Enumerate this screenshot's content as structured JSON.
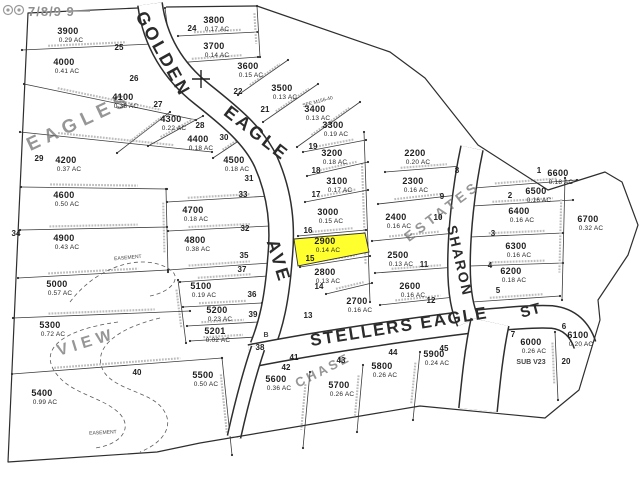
{
  "map": {
    "title": "subdivision plat map",
    "highlight": {
      "lot_id": "2900",
      "color": "#ffff2e"
    },
    "watermark": {
      "text": "7/8/9 9"
    },
    "streets": [
      {
        "label": "GOLDEN",
        "x": 158,
        "y": 57,
        "rotate": 61,
        "size": 18,
        "spacing": 3
      },
      {
        "label": "EAGLE",
        "x": 253,
        "y": 138,
        "rotate": 38,
        "size": 18,
        "spacing": 3
      },
      {
        "label": "AVE",
        "x": 273,
        "y": 263,
        "rotate": 73,
        "size": 18,
        "spacing": 3
      },
      {
        "label": "SHARON",
        "x": 455,
        "y": 262,
        "rotate": 77,
        "size": 14,
        "spacing": 2
      },
      {
        "label": "STELLERS EAGLE",
        "x": 400,
        "y": 332,
        "rotate": -9,
        "size": 17,
        "spacing": 2
      },
      {
        "label": "ST",
        "x": 532,
        "y": 315,
        "rotate": -15,
        "size": 15,
        "spacing": 1
      }
    ],
    "subdivision_labels": [
      {
        "label": "EAGLES",
        "x": 82,
        "y": 127,
        "rotate": -25,
        "size": 19,
        "spacing": 6
      },
      {
        "label": "ESTATES",
        "x": 445,
        "y": 215,
        "rotate": -37,
        "size": 14,
        "spacing": 4
      },
      {
        "label": "VIEW",
        "x": 88,
        "y": 347,
        "rotate": -17,
        "size": 16,
        "spacing": 5
      },
      {
        "label": "CHASE",
        "x": 325,
        "y": 374,
        "rotate": -27,
        "size": 13,
        "spacing": 3
      }
    ],
    "lots": [
      {
        "id": "3800",
        "area": "0.17 AC",
        "x": 214,
        "y": 23
      },
      {
        "id": "3700",
        "area": "0.14 AC",
        "x": 214,
        "y": 49
      },
      {
        "id": "3900",
        "area": "0.29 AC",
        "x": 68,
        "y": 34
      },
      {
        "id": "4000",
        "area": "0.41 AC",
        "x": 64,
        "y": 65
      },
      {
        "id": "4100",
        "area": "0.38 AC",
        "x": 123,
        "y": 100
      },
      {
        "id": "4300",
        "area": "0.22 AC",
        "x": 171,
        "y": 122
      },
      {
        "id": "4400",
        "area": "0.18 AC",
        "x": 198,
        "y": 142
      },
      {
        "id": "4500",
        "area": "0.18 AC",
        "x": 234,
        "y": 163
      },
      {
        "id": "3600",
        "area": "0.15 AC",
        "x": 248,
        "y": 69
      },
      {
        "id": "3500",
        "area": "0.13 AC",
        "x": 282,
        "y": 91
      },
      {
        "id": "3400",
        "area": "0.13 AC",
        "x": 315,
        "y": 112
      },
      {
        "id": "3300",
        "area": "0.19 AC",
        "x": 333,
        "y": 128
      },
      {
        "id": "3200",
        "area": "0.18 AC",
        "x": 332,
        "y": 156
      },
      {
        "id": "3100",
        "area": "0.17 AC",
        "x": 337,
        "y": 184
      },
      {
        "id": "3000",
        "area": "0.15 AC",
        "x": 328,
        "y": 215
      },
      {
        "id": "2900",
        "area": "0.14 AC",
        "x": 325,
        "y": 244,
        "highlighted": true
      },
      {
        "id": "2800",
        "area": "0.13 AC",
        "x": 325,
        "y": 275
      },
      {
        "id": "2700",
        "area": "0.16 AC",
        "x": 357,
        "y": 304
      },
      {
        "id": "2600",
        "area": "0.16 AC",
        "x": 410,
        "y": 289
      },
      {
        "id": "2500",
        "area": "0.13 AC",
        "x": 398,
        "y": 258
      },
      {
        "id": "2400",
        "area": "0.16 AC",
        "x": 396,
        "y": 220
      },
      {
        "id": "2300",
        "area": "0.16 AC",
        "x": 413,
        "y": 184
      },
      {
        "id": "2200",
        "area": "0.20 AC",
        "x": 415,
        "y": 156
      },
      {
        "id": "4200",
        "area": "0.37 AC",
        "x": 66,
        "y": 163
      },
      {
        "id": "4600",
        "area": "0.50 AC",
        "x": 64,
        "y": 198
      },
      {
        "id": "4700",
        "area": "0.18 AC",
        "x": 193,
        "y": 213
      },
      {
        "id": "4800",
        "area": "0.38 AC",
        "x": 195,
        "y": 243
      },
      {
        "id": "4900",
        "area": "0.43 AC",
        "x": 64,
        "y": 241
      },
      {
        "id": "5000",
        "area": "0.57 AC",
        "x": 57,
        "y": 287
      },
      {
        "id": "5100",
        "area": "0.19 AC",
        "x": 201,
        "y": 289
      },
      {
        "id": "5200",
        "area": "0.23 AC",
        "x": 217,
        "y": 313
      },
      {
        "id": "5201",
        "area": "0.02 AC",
        "x": 215,
        "y": 334
      },
      {
        "id": "5300",
        "area": "0.72 AC",
        "x": 50,
        "y": 328
      },
      {
        "id": "5400",
        "area": "0.99 AC",
        "x": 42,
        "y": 396
      },
      {
        "id": "5500",
        "area": "0.50 AC",
        "x": 203,
        "y": 378
      },
      {
        "id": "5600",
        "area": "0.36 AC",
        "x": 276,
        "y": 382
      },
      {
        "id": "5700",
        "area": "0.26 AC",
        "x": 339,
        "y": 388
      },
      {
        "id": "5800",
        "area": "0.26 AC",
        "x": 382,
        "y": 369
      },
      {
        "id": "5900",
        "area": "0.24 AC",
        "x": 434,
        "y": 357
      },
      {
        "id": "6000",
        "area": "0.26 AC",
        "x": 531,
        "y": 345
      },
      {
        "id": "6100",
        "area": "0.20 AC",
        "x": 578,
        "y": 338
      },
      {
        "id": "6200",
        "area": "0.18 AC",
        "x": 511,
        "y": 274
      },
      {
        "id": "6300",
        "area": "0.16 AC",
        "x": 516,
        "y": 249
      },
      {
        "id": "6400",
        "area": "0.16 AC",
        "x": 519,
        "y": 214
      },
      {
        "id": "6500",
        "area": "0.16 AC",
        "x": 536,
        "y": 194
      },
      {
        "id": "6600",
        "area": "0.18 AC",
        "x": 558,
        "y": 176
      },
      {
        "id": "6700",
        "area": "0.32 AC",
        "x": 588,
        "y": 222
      }
    ],
    "lot_numbers": [
      {
        "n": "25",
        "x": 119,
        "y": 50
      },
      {
        "n": "26",
        "x": 134,
        "y": 81
      },
      {
        "n": "27",
        "x": 158,
        "y": 107
      },
      {
        "n": "28",
        "x": 200,
        "y": 128
      },
      {
        "n": "30",
        "x": 224,
        "y": 140
      },
      {
        "n": "29",
        "x": 39,
        "y": 161
      },
      {
        "n": "34",
        "x": 16,
        "y": 236
      },
      {
        "n": "22",
        "x": 238,
        "y": 94
      },
      {
        "n": "21",
        "x": 265,
        "y": 112
      },
      {
        "n": "24",
        "x": 192,
        "y": 31
      },
      {
        "n": "31",
        "x": 249,
        "y": 181
      },
      {
        "n": "33",
        "x": 243,
        "y": 197
      },
      {
        "n": "32",
        "x": 245,
        "y": 231
      },
      {
        "n": "35",
        "x": 244,
        "y": 258
      },
      {
        "n": "37",
        "x": 242,
        "y": 272
      },
      {
        "n": "36",
        "x": 252,
        "y": 297
      },
      {
        "n": "39",
        "x": 253,
        "y": 317
      },
      {
        "n": "38",
        "x": 260,
        "y": 350
      },
      {
        "n": "41",
        "x": 294,
        "y": 360
      },
      {
        "n": "19",
        "x": 313,
        "y": 149
      },
      {
        "n": "18",
        "x": 316,
        "y": 173
      },
      {
        "n": "17",
        "x": 316,
        "y": 197
      },
      {
        "n": "16",
        "x": 308,
        "y": 233
      },
      {
        "n": "15",
        "x": 310,
        "y": 261
      },
      {
        "n": "14",
        "x": 319,
        "y": 289
      },
      {
        "n": "13",
        "x": 308,
        "y": 318
      },
      {
        "n": "12",
        "x": 431,
        "y": 303
      },
      {
        "n": "11",
        "x": 424,
        "y": 267
      },
      {
        "n": "10",
        "x": 438,
        "y": 220
      },
      {
        "n": "9",
        "x": 442,
        "y": 199
      },
      {
        "n": "8",
        "x": 457,
        "y": 173
      },
      {
        "n": "5",
        "x": 498,
        "y": 293
      },
      {
        "n": "4",
        "x": 490,
        "y": 268
      },
      {
        "n": "3",
        "x": 493,
        "y": 236
      },
      {
        "n": "2",
        "x": 510,
        "y": 198
      },
      {
        "n": "1",
        "x": 539,
        "y": 173
      },
      {
        "n": "42",
        "x": 286,
        "y": 370
      },
      {
        "n": "43",
        "x": 341,
        "y": 363
      },
      {
        "n": "44",
        "x": 393,
        "y": 355
      },
      {
        "n": "45",
        "x": 444,
        "y": 351
      },
      {
        "n": "7",
        "x": 513,
        "y": 337
      },
      {
        "n": "6",
        "x": 564,
        "y": 329
      },
      {
        "n": "20",
        "x": 566,
        "y": 364
      },
      {
        "n": "40",
        "x": 137,
        "y": 375
      }
    ],
    "annotations": [
      {
        "text": "SUB V23",
        "x": 531,
        "y": 364,
        "size": 7,
        "rotate": 0,
        "bold": true
      },
      {
        "text": "B",
        "x": 266,
        "y": 337,
        "size": 7,
        "rotate": 0,
        "bold": true
      },
      {
        "text": "EASEMENT",
        "x": 128,
        "y": 259,
        "size": 5,
        "rotate": -5,
        "bold": false
      },
      {
        "text": "EASEMENT",
        "x": 103,
        "y": 434,
        "size": 5,
        "rotate": -3,
        "bold": false
      },
      {
        "text": "SEE M156-40",
        "x": 318,
        "y": 103,
        "size": 5,
        "rotate": -15,
        "bold": false
      }
    ]
  }
}
